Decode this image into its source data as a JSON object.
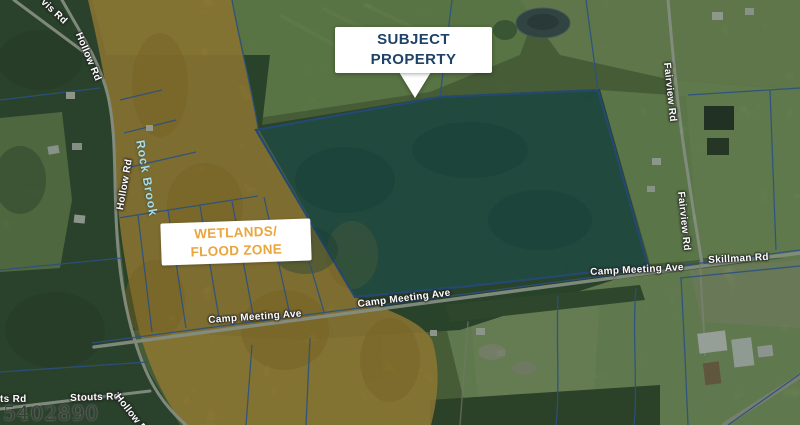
{
  "map": {
    "watermark": "5402890",
    "callout": {
      "line1": "SUBJECT",
      "line2": "PROPERTY",
      "text_color": "#1e4268"
    },
    "wetlands_label": {
      "line1": "WETLANDS/",
      "line2": "FLOOD ZONE",
      "text_color": "#eaa63c"
    },
    "labels": {
      "roads": [
        {
          "id": "vis-rd-partial",
          "text": "vis Rd"
        },
        {
          "id": "hollow-rd-upper",
          "text": "Hollow Rd"
        },
        {
          "id": "hollow-rd-mid",
          "text": "Hollow Rd"
        },
        {
          "id": "camp-meeting-ave-west",
          "text": "Camp Meeting Ave"
        },
        {
          "id": "camp-meeting-ave-center",
          "text": "Camp Meeting Ave"
        },
        {
          "id": "camp-meeting-ave-east",
          "text": "Camp Meeting Ave"
        },
        {
          "id": "skillman-rd",
          "text": "Skillman Rd"
        },
        {
          "id": "fairview-rd-upper",
          "text": "Fairview Rd"
        },
        {
          "id": "fairview-rd-lower",
          "text": "Fairview Rd"
        },
        {
          "id": "stouts-rd",
          "text": "Stouts Rd"
        },
        {
          "id": "stouts-rd-partial",
          "text": "ts Rd"
        },
        {
          "id": "hollow-rd-bottom",
          "text": "Hollow Rd"
        }
      ],
      "water": [
        {
          "id": "rock-brook",
          "text": "Rock Brook",
          "color": "#a8dcec"
        }
      ]
    },
    "colors": {
      "subject_fill": "#10636e",
      "subject_stroke": "#2456a8",
      "wetlands_fill": "#e2a73d",
      "parcel_line": "#2e64c4",
      "road": "#c8cbc2"
    }
  }
}
